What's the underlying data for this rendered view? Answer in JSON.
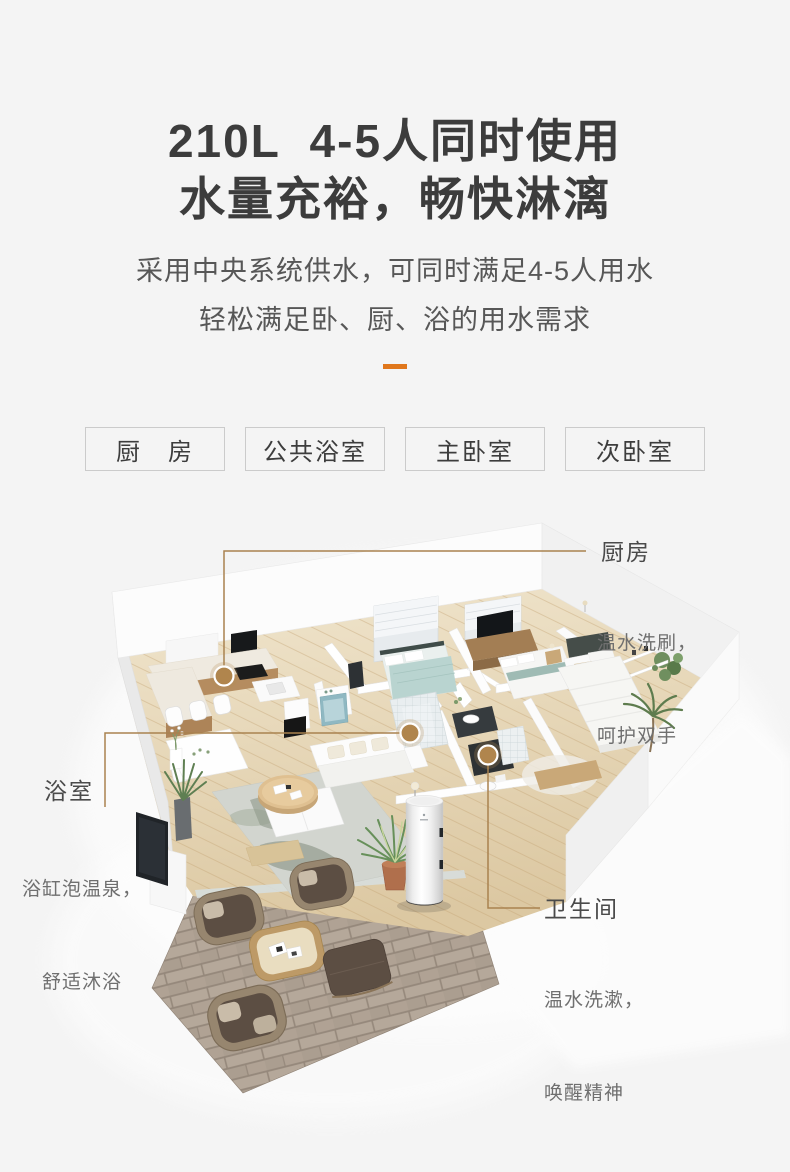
{
  "page": {
    "background": "#f4f4f4",
    "accent_color": "#e0771c",
    "callout_line_color": "#a9824f",
    "marker_color": "#b0854d"
  },
  "header": {
    "title_line1": "210L  4-5人同时使用",
    "title_line2": "水量充裕，畅快淋漓",
    "desc_line1": "采用中央系统供水，可同时满足4-5人用水",
    "desc_line2": "轻松满足卧、厨、浴的用水需求"
  },
  "tags": {
    "items": [
      {
        "label": "厨　房"
      },
      {
        "label": "公共浴室"
      },
      {
        "label": "主卧室"
      },
      {
        "label": "次卧室"
      }
    ]
  },
  "callouts": {
    "kitchen": {
      "title": "厨房",
      "line1": "温水洗刷，",
      "line2": "呵护双手"
    },
    "bathroom": {
      "title": "浴室",
      "line1": "浴缸泡温泉，",
      "line2": "舒适沐浴"
    },
    "toilet": {
      "title": "卫生间",
      "line1": "温水洗漱，",
      "line2": "唤醒精神"
    }
  }
}
